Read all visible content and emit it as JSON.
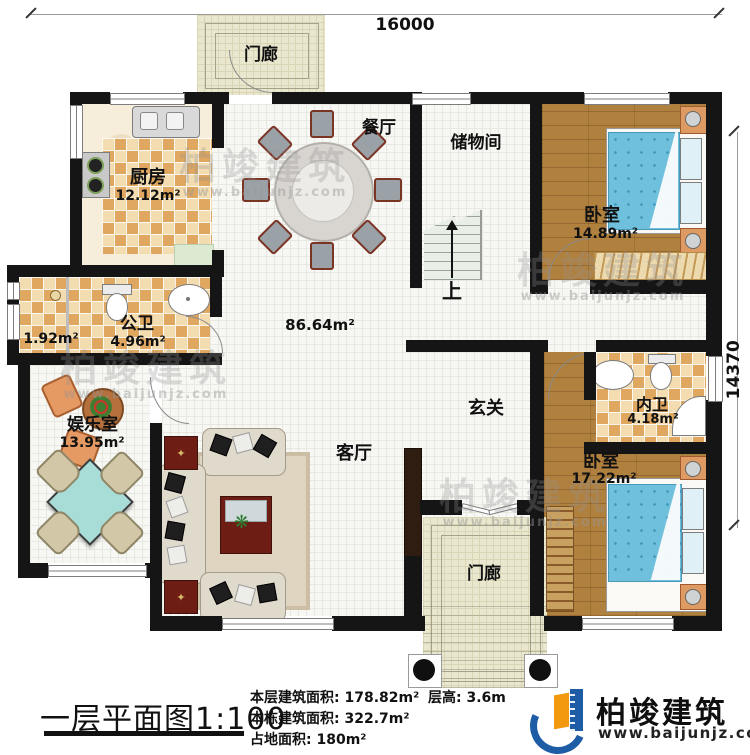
{
  "plan": {
    "dim_top": "16000",
    "dim_right": "14370",
    "stairs_up": "上",
    "rooms": {
      "porch_top": "门廊",
      "porch_bottom": "门廊",
      "kitchen": "厨房",
      "kitchen_area": "12.12m²",
      "dining": "餐厅",
      "storage": "储物间",
      "bedroom1": "卧室",
      "bedroom1_area": "14.89m²",
      "public_bath": "公卫",
      "public_bath_area": "4.96m²",
      "shower_area": "1.92m²",
      "open_area": "86.64m²",
      "entertainment": "娱乐室",
      "entertainment_area": "13.95m²",
      "foyer": "玄关",
      "living": "客厅",
      "ensuite": "内卫",
      "ensuite_area": "4.18m²",
      "bedroom2": "卧室",
      "bedroom2_area": "17.22m²"
    }
  },
  "title_block": {
    "title": "一层平面图",
    "scale": "1:100",
    "stats": [
      {
        "label": "本层建筑面积:",
        "value": "178.82m²"
      },
      {
        "label": "本栋建筑面积:",
        "value": "322.7m²"
      },
      {
        "label": "占地面积:",
        "value": "180m²"
      }
    ],
    "height_label": "层高:",
    "height_value": "3.6m"
  },
  "logo": {
    "name": "柏竣建筑",
    "url": "www.baijunjz.com"
  },
  "watermark": {
    "text": "柏竣建筑",
    "url": "www.baijunjz.com"
  },
  "colors": {
    "wall": "#151515",
    "checker_dark": "#dfa75f",
    "checker_light": "#f3ddb0",
    "wood": "#b0803e",
    "bed_blue": "#6fc0dc",
    "porch": "#eae7cf",
    "logo_blue": "#1e5ca6",
    "logo_orange": "#f2990f"
  }
}
